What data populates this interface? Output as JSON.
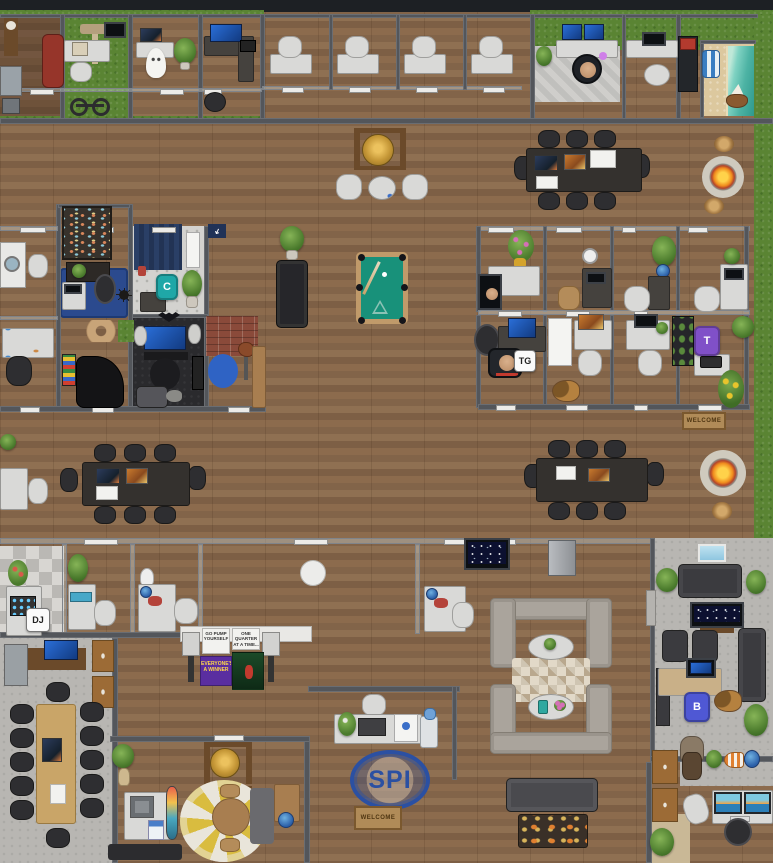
{
  "colors": {
    "teal": "#1fa7a7",
    "purple": "#8050c8",
    "blue": "#4f58d4",
    "spi_blue": "#2b50a2",
    "felt_green": "#18917a",
    "fire_orange": "#f08c1e",
    "bean_blue": "#2f63c4",
    "grass": "#5a8433"
  },
  "avatars": [
    {
      "initials": "C",
      "type": "letter-chair",
      "color": "#1fa7a7"
    },
    {
      "initials": "TG",
      "type": "name-badge",
      "color": "#ffffff"
    },
    {
      "initials": "T",
      "type": "letter-chair",
      "color": "#8050c8"
    },
    {
      "initials": "DJ",
      "type": "name-badge",
      "color": "#ffffff"
    },
    {
      "initials": "B",
      "type": "letter-chair",
      "color": "#4f58d4"
    }
  ],
  "posters": [
    {
      "text": "GO PUMP YOURSELF"
    },
    {
      "text": "ONE QUARTER AT A TIME..."
    },
    {
      "text": "EVERYONE'S A WINNER"
    }
  ],
  "signs": {
    "floor_logo": "SPI",
    "welcome_mat": "WELCOME",
    "arrow_glyph": "➜"
  }
}
